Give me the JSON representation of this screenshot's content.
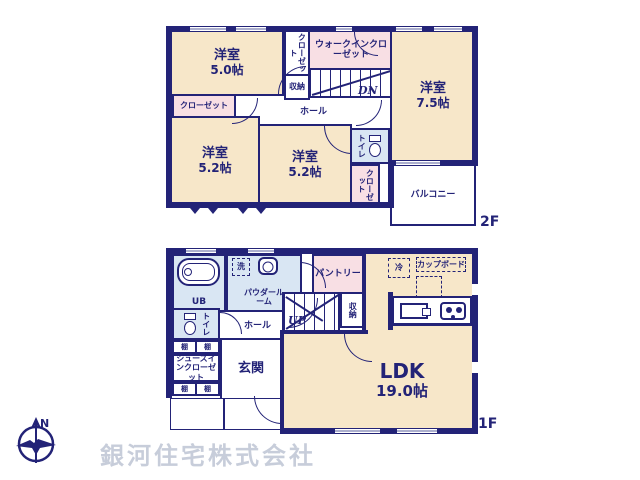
{
  "colors": {
    "wall_navy": "#232377",
    "room_cream": "#f7e7c9",
    "closet_pink": "#f8dfe4",
    "wet_area_blue": "#d9e6f3",
    "watermark_gray": "#c7cdda"
  },
  "floor2": {
    "tag": "2F",
    "room_50": {
      "name": "洋室",
      "size": "5.0帖"
    },
    "room_75": {
      "name": "洋室",
      "size": "7.5帖"
    },
    "room_52a": {
      "name": "洋室",
      "size": "5.2帖"
    },
    "room_52b": {
      "name": "洋室",
      "size": "5.2帖"
    },
    "closet_top": "クローゼット",
    "walkin_closet": "ウォークインクローゼット",
    "storage": "収納",
    "hall": "ホール",
    "stairs_down": "DN",
    "closet_left": "クローゼット",
    "toilet": "トイレ",
    "closet_balcony_side": "クローゼット",
    "balcony": "バルコニー"
  },
  "floor1": {
    "tag": "1F",
    "unit_bath": "UB",
    "laundry": "洗",
    "powder_room": "パウダールーム",
    "pantry": "パントリー",
    "fridge": "冷",
    "cupboard": "カップボード",
    "storage": "収納",
    "stairs_up": "UP",
    "toilet": "トイレ",
    "hall": "ホール",
    "shelf": "棚",
    "shoes_in_closet": "シューズインクローゼット",
    "entrance": "玄関",
    "ldk": {
      "name": "LDK",
      "size": "19.0帖"
    }
  },
  "compass_north": "N",
  "company_name": "銀河住宅株式会社"
}
